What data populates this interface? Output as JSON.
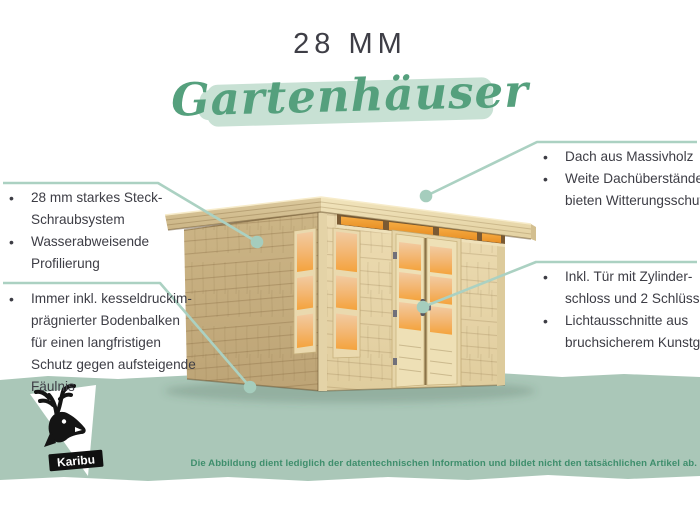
{
  "title": {
    "size_label": "28 MM",
    "category": "Gartenhäuser"
  },
  "callouts": {
    "top_left": {
      "items": [
        {
          "lines": [
            "28 mm starkes Steck-",
            "Schraubsystem"
          ]
        },
        {
          "lines": [
            "Wasserabweisende",
            "Profilierung"
          ]
        }
      ]
    },
    "bottom_left": {
      "items": [
        {
          "lines": [
            "Immer inkl. kesseldruckim-",
            "prägnierter Bodenbalken",
            "für einen langfristigen",
            "Schutz gegen aufsteigende",
            "Fäulnis"
          ]
        }
      ]
    },
    "top_right": {
      "items": [
        {
          "lines": [
            "Dach aus Massivholz"
          ]
        },
        {
          "lines": [
            "Weite Dachüberstände",
            "bieten Witterungsschutz"
          ]
        }
      ]
    },
    "middle_right": {
      "items": [
        {
          "lines": [
            "Inkl. Tür mit Zylinder-",
            "schloss und 2 Schlüsseln"
          ]
        },
        {
          "lines": [
            "Lichtausschnitte aus",
            "bruchsicherem Kunstglas"
          ]
        }
      ]
    }
  },
  "footer": {
    "disclaimer": "Die Abbildung dient lediglich der datentechnischen Information und bildet nicht den tatsächlichen Artikel ab.",
    "brand": "Karibu"
  },
  "colors": {
    "accent_green": "#55a07d",
    "brush_green": "#c8e1d4",
    "band_green": "#aac7b8",
    "callout_line": "#abd1c2",
    "text_dark": "#3d3d45",
    "disclaimer_green": "#3e8e6c",
    "wood_light": "#ecdcb1",
    "wood_mid": "#c9b283",
    "glass_orange": "#f4a845"
  }
}
